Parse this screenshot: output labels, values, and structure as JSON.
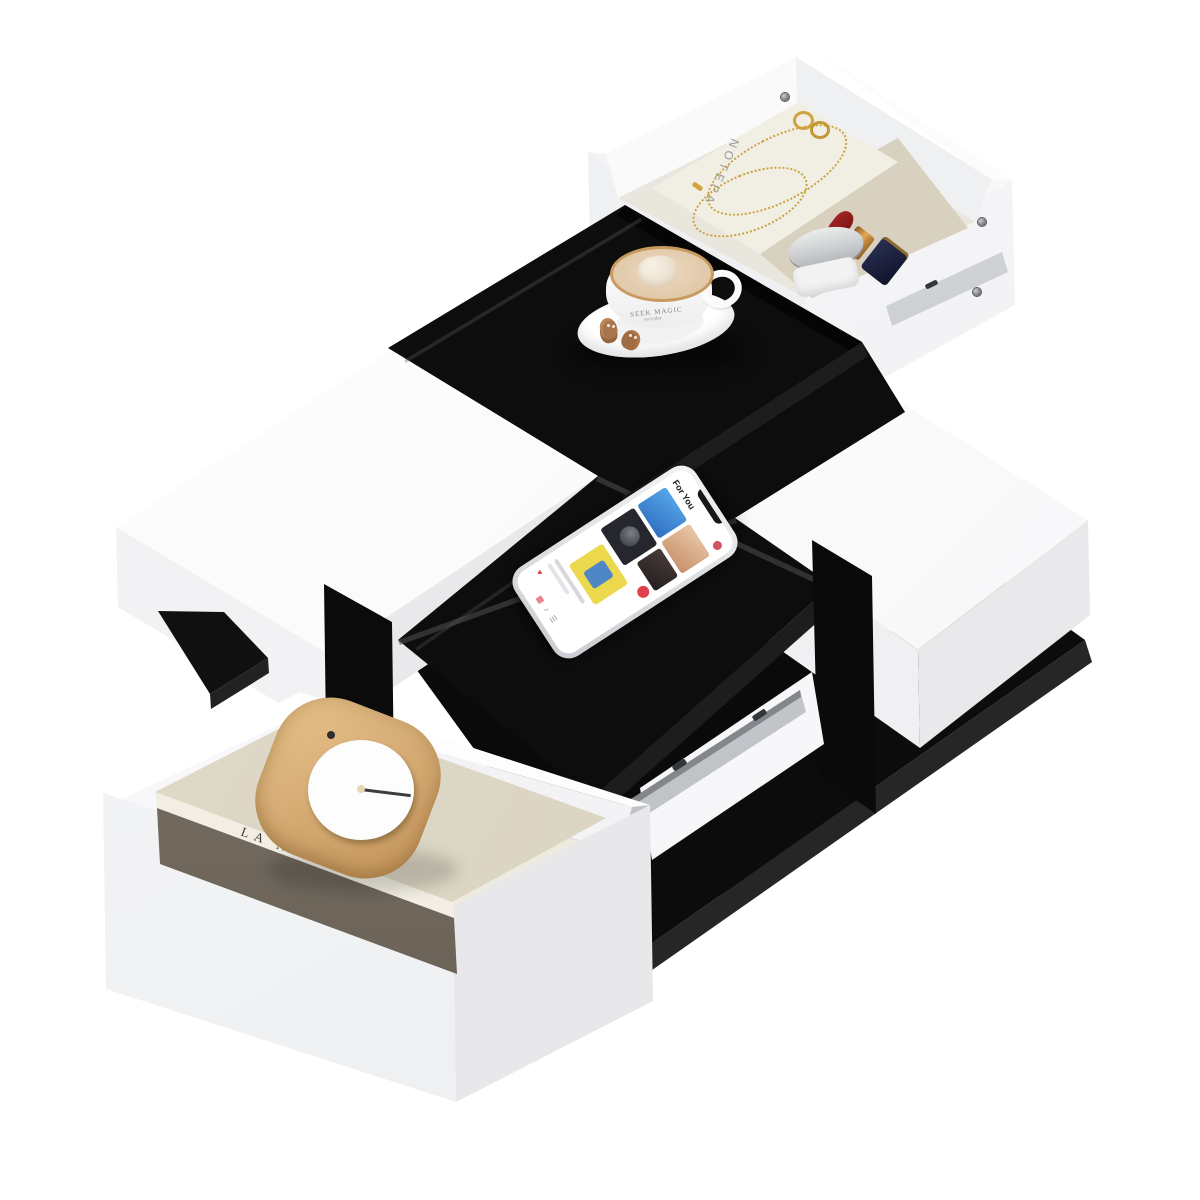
{
  "image": {
    "type": "product-render",
    "subject": "Modern black and white checkerboard coffee table with two pulled-out hidden drawers",
    "background_color": "#ffffff",
    "colors": {
      "table_black": "#0d0d0d",
      "table_white": "#f4f4f6",
      "wood": "#d4a96c",
      "gold": "#c8a23d",
      "lipstick_red": "#8c1f1f",
      "rail_silver": "#c6c9cd"
    }
  },
  "top_drawer": {
    "position": "upper right, pulled open",
    "notepad": {
      "label": "NOTEPA"
    },
    "items": [
      "notepad",
      "gold necklace",
      "gold rings",
      "red lipstick with navy cap",
      "silver cream jar"
    ]
  },
  "tabletop": {
    "coffee_cup": {
      "brand_label": "SEEK MAGIC",
      "sub_label": "everyday",
      "latte_art": "heart",
      "cookies": "2 gingerbread cookies",
      "rim": "gold"
    },
    "smartphone": {
      "app_header": "For You",
      "screen": "music app with album tiles"
    }
  },
  "bottom_drawer": {
    "position": "lower left, pulled open",
    "book": {
      "cover_title": "THE"
    },
    "book_spine": {
      "title_small": "THE KINFOLK",
      "title_large": "LA NONNA"
    },
    "clock": "rounded square wooden clock with white face and single hand"
  }
}
